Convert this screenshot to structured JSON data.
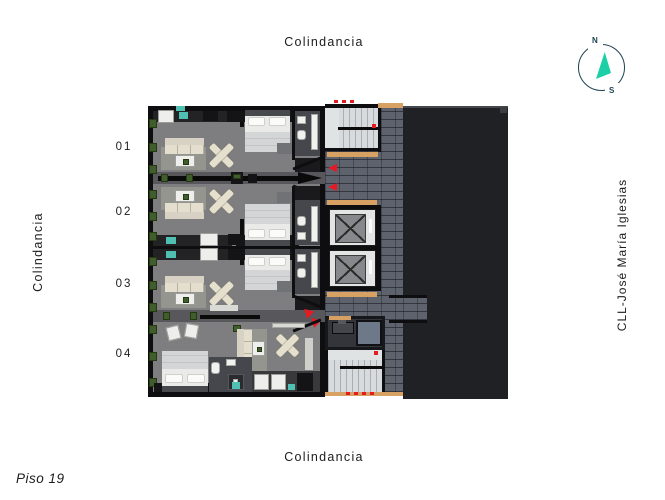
{
  "boundaries": {
    "top": "Colindancia",
    "bottom": "Colindancia",
    "left": "Colindancia",
    "right": "CLL-José María Iglesias"
  },
  "floor_label": "Piso 19",
  "units": [
    {
      "label": "01"
    },
    {
      "label": "02"
    },
    {
      "label": "03"
    },
    {
      "label": "04"
    }
  ],
  "compass": {
    "north": "N",
    "south": "S"
  },
  "colors": {
    "wall": "#0e0e10",
    "floor": "#7e7e80",
    "corridor": "#57575c",
    "brick": "#5d626c",
    "mass": "#202124",
    "stair": "#d8dbdd",
    "tan": "#d8a164",
    "red": "#e51a23",
    "teal": "#4fc0b1",
    "cream": "#e5dfce",
    "ring": "#1d4353",
    "needle": "#1bcfa6",
    "text": "#1c1c1c"
  }
}
